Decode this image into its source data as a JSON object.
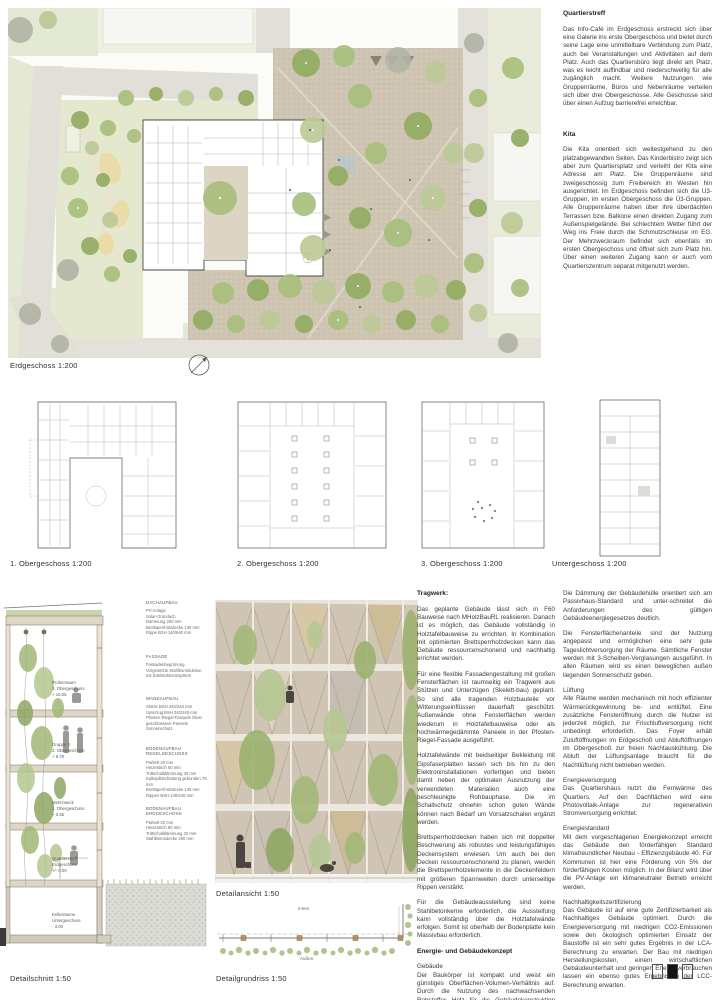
{
  "captions": {
    "site_plan": "Erdgeschoss 1:200",
    "plan1": "1. Obergeschoss 1:200",
    "plan2": "2. Obergeschoss 1:200",
    "plan3": "3. Obergeschoss 1:200",
    "plan4": "Untergeschoss 1:200",
    "detail_section": "Detailschnitt  1:50",
    "detail_view": "Detailansicht 1:50",
    "detail_plan": "Detailgrundriss 1:50"
  },
  "icons": {
    "north_arrow": "north-arrow compass symbol",
    "page_marker": "sheet 2 of 3 indicator squares"
  },
  "colors": {
    "plaza_tan": "#cec5b2",
    "lawn_green": "#e3e8ce",
    "tree_green": "#a9bf7d",
    "road_grey": "#e1dfd7",
    "facade_beige": "#d0c5b5"
  },
  "quartierstreff": {
    "title": "Quartierstreff",
    "body": "Das Info-Café im Erdgeschoss erstreckt sich über eine Galerie ins erste Obergeschoss und bietet durch seine Lage eine unmittelbare Verbindung zum Platz, auch bei Veranstaltungen und Aktivitäten auf dem Platz. Auch das Quartiersbüro liegt direkt am Platz, was es leicht auffindbar und niederschwellig für alle zugänglich macht. Weitere Nutzungen wie Gruppenräume, Büros und Nebenräume verteilen sich über drei Obergeschosse. Alle Geschosse sind über einen Aufzug barrierefrei erreichbar."
  },
  "kita": {
    "title": "Kita",
    "body": "Die Kita orientiert sich weitestgehend zu den platzabgewandten Seiten. Das Kinderbistro zeigt sich aber zum Quartiersplatz und verleiht der Kita eine Adresse am Platz. Die Gruppenräume sind zweigeschossig zum Freibereich im Westen hin ausgerichtet. Im Erdgeschoss befinden sich die U3-Gruppen, im ersten Obergeschoss die Ü3-Gruppen. Alle Gruppenräume haben über ihre überdachten Terrassen bzw. Balkone einen direkten Zugang zum Außenspielgelände. Bei schlechtem Wetter führt der Weg ins Freie durch die Schmutzschleuse im EG. Der Mehrzweckraum befindet sich ebenfalls im ersten Obergeschoss und öffnet sich zum Platz hin. Über einen weiteren Zugang kann er auch vom Quartierszentrum separat mitgenutzt werden."
  },
  "tragwerk": {
    "title": "Tragwerk:",
    "p1": "Das geplante Gebäude lässt sich in F60 Bauweise nach MHolzBauRL realisieren. Danach ist es möglich, das Gebäude vollständig in Holztafelbauweise zu errichten. In Kombination mit optimierten Brettsperrholzdecken kann das Gebäude ressourcenschonend und nachhaltig errichtet werden.",
    "p2": "Für eine flexible Fassadengestaltung mit großen Fensterflächen ist raumseitig ein Tragwerk aus Stützen und Unterzügen (Skelett-bau) geplant. So sind alle tragenden Holzbauteile vor Witterungseinflüssen dauerhaft geschützt. Außenwände ohne Fensterflächen werden wiederum in Holztafelbauweise oder als hochwärmegedämmte Paneele in der Pfosten-Riegel-Fassade ausgeführt.",
    "p3": "Holztafelwände mit beidseitiger Bekleidung mit Gipsfaserplatten lassen sich bis hin zu den Elektroninstallationen vorfertigen und bieten damit neben der optimalen Ausnutzung der verwendeten Materialien auch eine beschleunigte Rohbauphase. Die im Schallschutz ohnehin schon guten Wände können nach Bedarf um Vorsatzschalen ergänzt werden.",
    "p4": "Brettsperrholzdecken haben sich mit doppelter Beschwerung als robustes und leistungsfähiges Deckensystem erwiesen. Um auch bei den Decken ressourcenschonend zu planen, werden die Brettsperrholzelemente in die Deckenfeldern mit größeren Spannweiten durch unterseitige Rippen verstärkt.",
    "p5": "Für die Gebäudeaussteifung sind keine Stahlbetonkerne erforderlich, die Aussteifung kann vollständig über die Holztafelwände erfolgen. Somit ist oberhalb der Bodenplatte kein Massivbau erforderlich."
  },
  "energie": {
    "title": "Energie- und Gebäudekonzept",
    "gebaeude_title": "Gebäude",
    "gebaeude_body": "Der Baukörper ist kompakt und weist ein günstiges Oberflächen-Volumen-Verhältnis auf. Durch die Nutzung des nachwachsenden Rohstoffes Holz für die Gebäudekonstruktion wird die Graue Energie für die Erstellung des Gebäudes wesentlich reduziert."
  },
  "right_bottom": {
    "p1": "Die Dämmung der Gebäudehülle orientiert sich am Passivhaus-Standard und unter-schreitet die Anforderungen des gültigen Gebäudeenergiegesetzes deutlich.",
    "p2": "Die Fensterflächenanteile sind der Nutzung angepasst und ermöglichen eine sehr gute Tageslichtversorgung der Räume. Sämtliche Fenster werden mit 3-Scheiben-Verglasungen ausgeführt. In allen Räumen wird es einen beweglichen außen liegenden Sonnenschutz geben.",
    "lueftung_title": "Lüftung",
    "lueftung_body": "Alle Räume werden mechanisch mit hoch effizienter Wärmerückgewinnung be- und entlüftet. Eine zusätzliche Fensteröffnung durch die Nutzer ist jederzeit möglich, zur Frischluftversorgung nicht unbedingt erforderlich. Das Foyer erhält Zuluftöffnungen im Erdgeschoß und Abluftöffnungen im Obergeschoß zur freien Nachtauskühlung. Die Abluft der Lüftungsanlage braucht für die Nachtlüftung nicht betrieben werden.",
    "energieversorgung_title": "Energieversorgung",
    "energieversorgung_body": "Das Quartiershaus nutzt die Fernwärme des Quartiers. Auf den Dachflächen wird eine Photovoltaik-Anlage zur regenerativen Stromversorgung errichtet.",
    "energiestandard_title": "Energiestandard",
    "energiestandard_body": "Mit dem vorgeschlagenen Energiekonzept erreicht das Gebäude den förderfähigen Standard klimafreundlicher Neubau - Effizienzgebäude 40. Für Kommunen ist hier eine Förderung von 5% der förderfähigen Kosten möglich. In der Bilanz wird über die PV-Anlage ein klimaneutraler Betrieb erreicht werden.",
    "nachhaltigkeit_title": "Nachhaltigkeitszertifizierung",
    "nachhaltigkeit_body": "Das Gebäude ist auf eine gute Zertifizierbarkeit als Nachhaltiges Gebäude optimiert. Durch die Energieversorgung mit niedrigen CO2-Emissionen sowie den ökologisch optimierten Einsatz der Baustoffe ist ein sehr gutes Ergebnis in der LCA-Berechnung zu erwarten. Der Bau mit niedrigen Herstellungskosten, einem wirtschaftlichen Gebäudeunterhalt und geringen Energieverbräuchen lassen ein ebenso gutes Ergebnis in der LCC-Berechnung erwarten."
  },
  "detail_labels": {
    "dach": {
      "title": "DACHAUFBAU",
      "lines": "PV-Anlage\nSolar-Gründach\nDämmung 200 mm\nBrettsperrholzdecke 140 mm\nRippe BSH 140/640 mm"
    },
    "fassade": {
      "title": "FASSADE",
      "lines": "Fassadenbegrünung\nVorgesetzte Stahlkonstruktion\nmit Edelstahlnetzsystem"
    },
    "wand": {
      "title": "WANDAUFBAU",
      "lines": "Stütze BSH 240/240 mm\nUnterzug BSH 240/240 mm\nPfosten-Riegel-Fassade Glas/\ngeschlossene Paneele\nSonnenschutz"
    },
    "boden_regel": {
      "title": "BODENAUFBAU\nREGELGESCHOSS",
      "lines": "Parkett 20 mm\nHeizestrich 60 mm\nTrittschalldämmung 30 mm\nKalksplittschüttung gebunden 70 mm\nBrettsperrholzdecke 140 mm\nRippen BSH 140/240 mm"
    },
    "boden_eg": {
      "title": "BODENAUFBAU\nERDGESCHOSS",
      "lines": "Parkett 20 mm\nHeizestrich 60 mm\nTrittschalldämmung 20 mm\nStahlbetondecke 250 mm"
    }
  },
  "floors": [
    {
      "name": "Probenraum",
      "level": "3. Obergeschoss",
      "elev": "+ 10.05"
    },
    {
      "name": "Gruppe 2",
      "level": "2. Obergeschoss",
      "elev": "+ 6.70"
    },
    {
      "name": "Mehrzweck",
      "level": "1. Obergeschoss",
      "elev": "+ 3.35"
    },
    {
      "name": "Quartierstreff",
      "level": "Erdgeschoss",
      "elev": "+/- 0.00"
    },
    {
      "name": "Kellerräume",
      "level": "Untergeschoss",
      "elev": "- 3.00"
    }
  ],
  "detail_plan": {
    "inner": "Innen",
    "outer": "Außen"
  }
}
